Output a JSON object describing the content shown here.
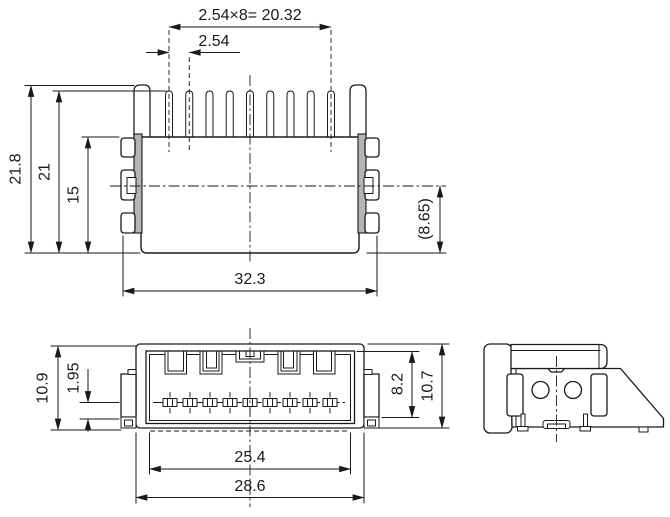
{
  "colors": {
    "line": "#1a1a1a",
    "background": "#ffffff",
    "bracket_plate_fill": "#b4b4b4"
  },
  "dimensions": {
    "top_view": {
      "pitch_total": "2.54×8= 20.32",
      "pitch": "2.54",
      "overall_height": "21.8",
      "pin_height": "21",
      "body_height": "15",
      "ref_height": "(8.65)",
      "body_width": "32.3"
    },
    "front_view": {
      "overall_height": "10.9",
      "contact_offset": "1.95",
      "cavity_height": "8.2",
      "body_height": "10.7",
      "cavity_width": "25.4",
      "body_width": "28.6"
    }
  }
}
